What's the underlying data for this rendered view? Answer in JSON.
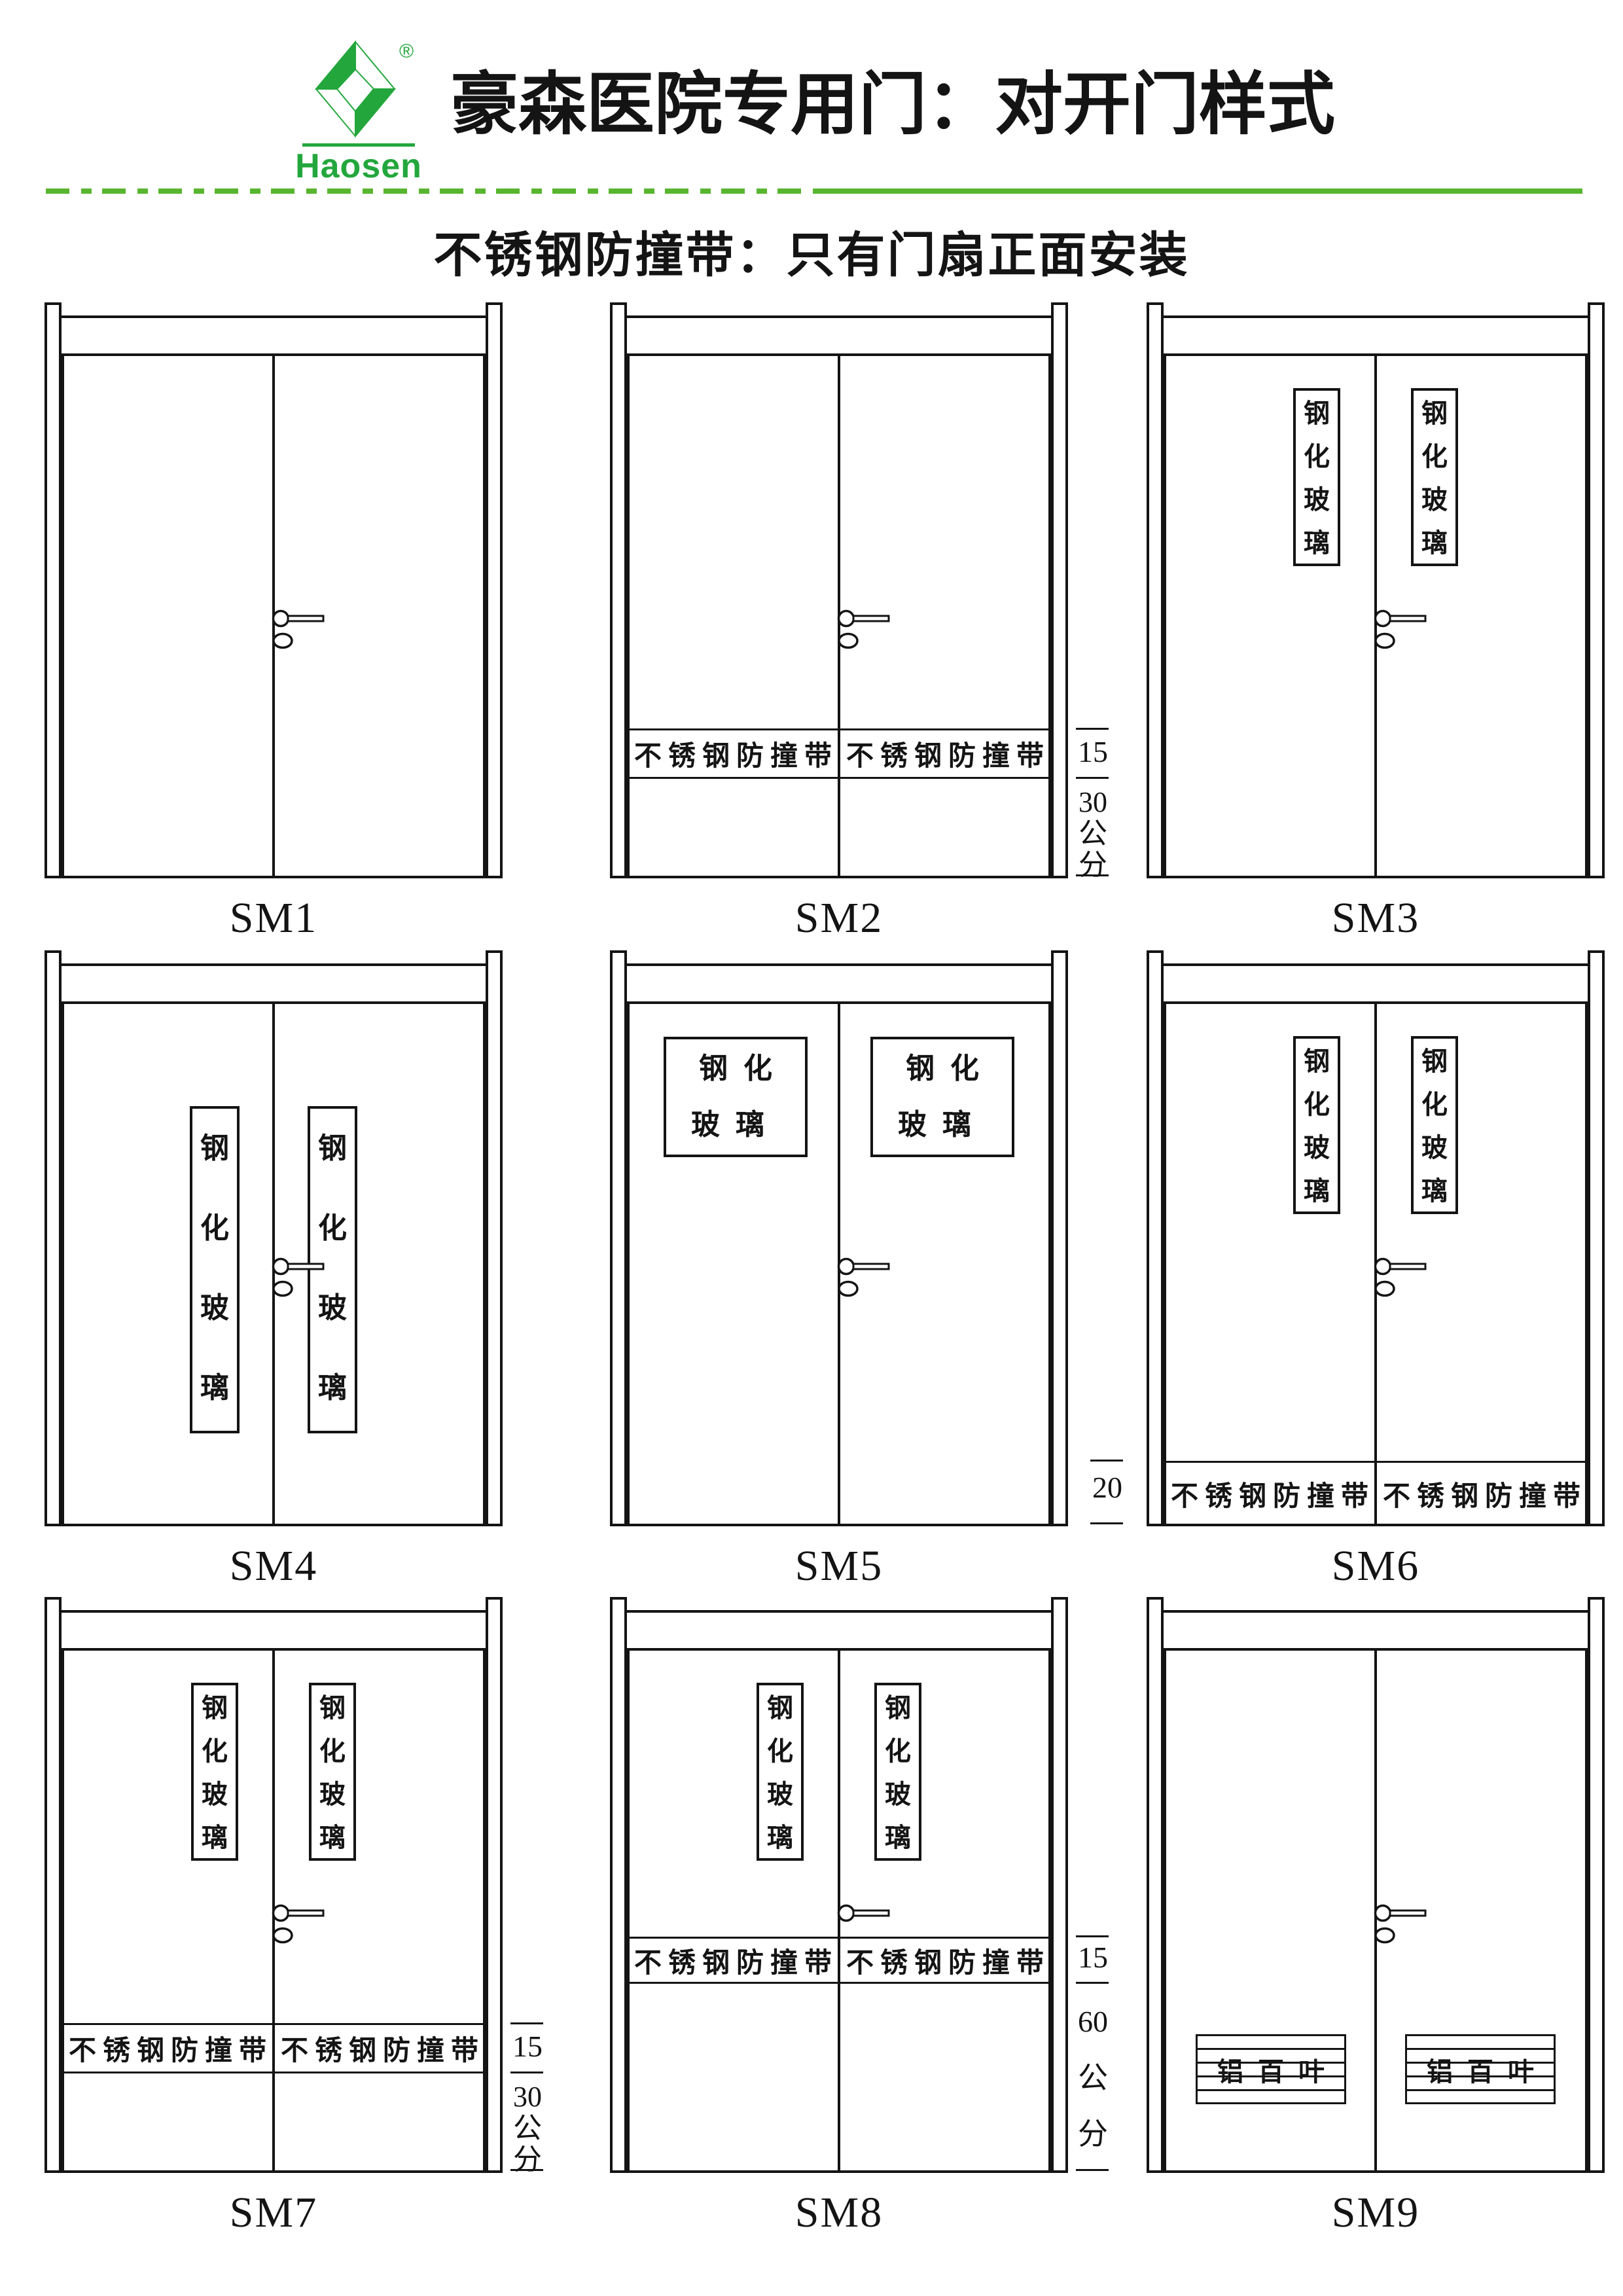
{
  "header": {
    "logo": {
      "brand": "Haosen",
      "registered": "®",
      "green": "#23a73c"
    },
    "title": "豪森医院专用门：对开门样式",
    "subtitle": "不锈钢防撞带：只有门扇正面安装",
    "rule_green": "#58b52f"
  },
  "doors": [
    {
      "label": "SM1"
    },
    {
      "label": "SM2",
      "band_left": "不锈钢防撞带",
      "band_right": "不锈钢防撞带",
      "dim_1": "15",
      "dim_2": "30\n公\n分"
    },
    {
      "label": "SM3",
      "glass_left": "钢\n化\n玻\n璃",
      "glass_right": "钢\n化\n玻\n璃"
    },
    {
      "label": "SM4",
      "glass_left": "钢\n化\n玻\n璃",
      "glass_right": "钢\n化\n玻\n璃"
    },
    {
      "label": "SM5",
      "glass_left": "钢化\n玻璃",
      "glass_right": "钢化\n玻璃"
    },
    {
      "label": "SM6",
      "glass_left": "钢\n化\n玻\n璃",
      "glass_right": "钢\n化\n玻\n璃",
      "band_left": "不锈钢防撞带",
      "band_right": "不锈钢防撞带",
      "dim_1": "20"
    },
    {
      "label": "SM7",
      "glass_left": "钢\n化\n玻\n璃",
      "glass_right": "钢\n化\n玻\n璃",
      "band_left": "不锈钢防撞带",
      "band_right": "不锈钢防撞带",
      "dim_1": "15",
      "dim_2": "30\n公\n分"
    },
    {
      "label": "SM8",
      "glass_left": "钢\n化\n玻\n璃",
      "glass_right": "钢\n化\n玻\n璃",
      "band_left": "不锈钢防撞带",
      "band_right": "不锈钢防撞带",
      "dim_1": "15",
      "dim_2": "60\n公\n分"
    },
    {
      "label": "SM9",
      "louver_left": "铝百叶",
      "louver_right": "铝百叶"
    }
  ]
}
